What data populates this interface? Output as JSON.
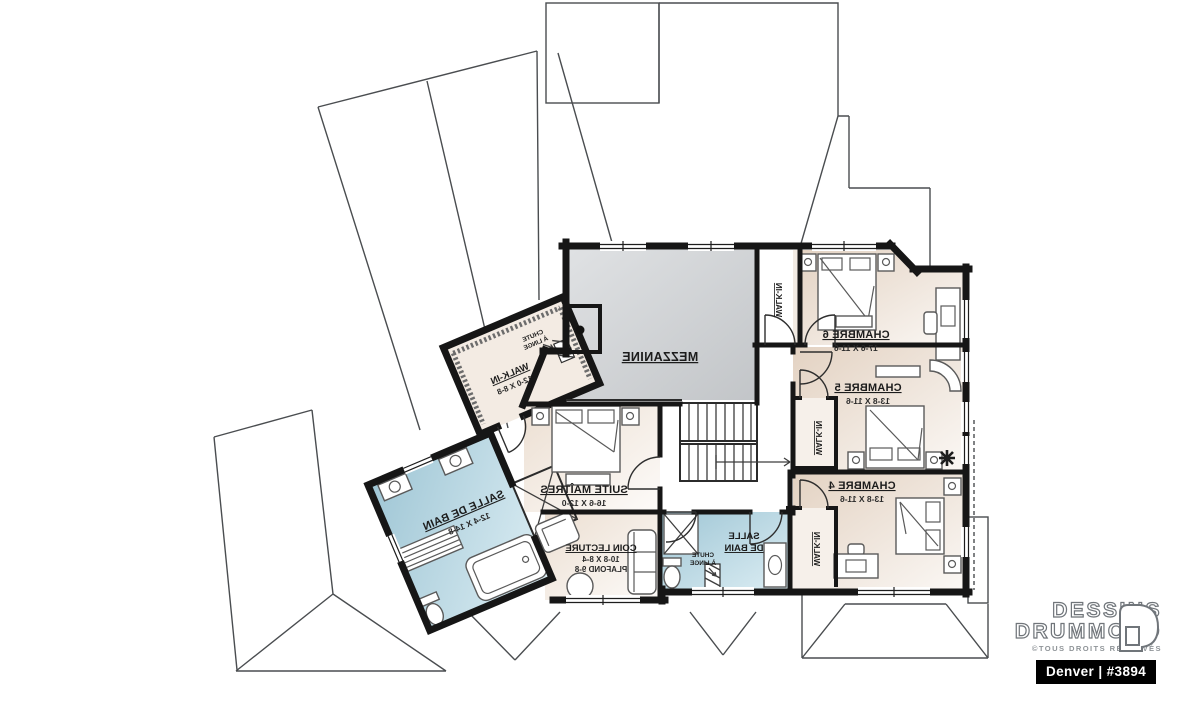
{
  "canvas": {
    "width": 1200,
    "height": 711
  },
  "brand": {
    "line1": "DESSINS",
    "line2": "DRUMMOND",
    "rights": "©TOUS DROITS RÉSERVÉS",
    "model_bar": "Denver | #3894"
  },
  "labels": {
    "mezzanine": "MEZZANINE",
    "walkin": "WALK-IN",
    "chambre6": {
      "name": "CHAMBRE 6",
      "dim": "17-6 X 11-6"
    },
    "chambre5": {
      "name": "CHAMBRE 5",
      "dim": "13-8 X 11-6"
    },
    "chambre4": {
      "name": "CHAMBRE 4",
      "dim": "13-8 X 11-6"
    },
    "suite": {
      "name": "SUITE MAÎTRES",
      "dim": "16-6 X 12-0"
    },
    "walkin_master": {
      "name": "WALK-IN",
      "dim": "12-0 X 8-8"
    },
    "bath_master": {
      "name": "SALLE DE BAIN",
      "dim": "12-4 X 14-8"
    },
    "bath_small": {
      "line1": "SALLE",
      "line2": "DE BAIN"
    },
    "lecture": {
      "name": "COIN LECTURE",
      "dim": "10-8 X 8-4",
      "ceiling": "PLAFOND 9-8"
    },
    "chute": {
      "line1": "CHUTE",
      "line2": "À LINGE"
    }
  },
  "colors": {
    "wall": "#161616",
    "bedroom_fill": "#e7d9cb",
    "bathroom_fill": "#a9cdda",
    "mezzanine_fill": "#cdd1d4",
    "roof_line": "#4a4d50",
    "brand_bar_bg": "#000000",
    "brand_bar_text": "#ffffff"
  },
  "notes": {
    "orientation": "mirrored (reverse) floor plan — all labels read flipped"
  }
}
